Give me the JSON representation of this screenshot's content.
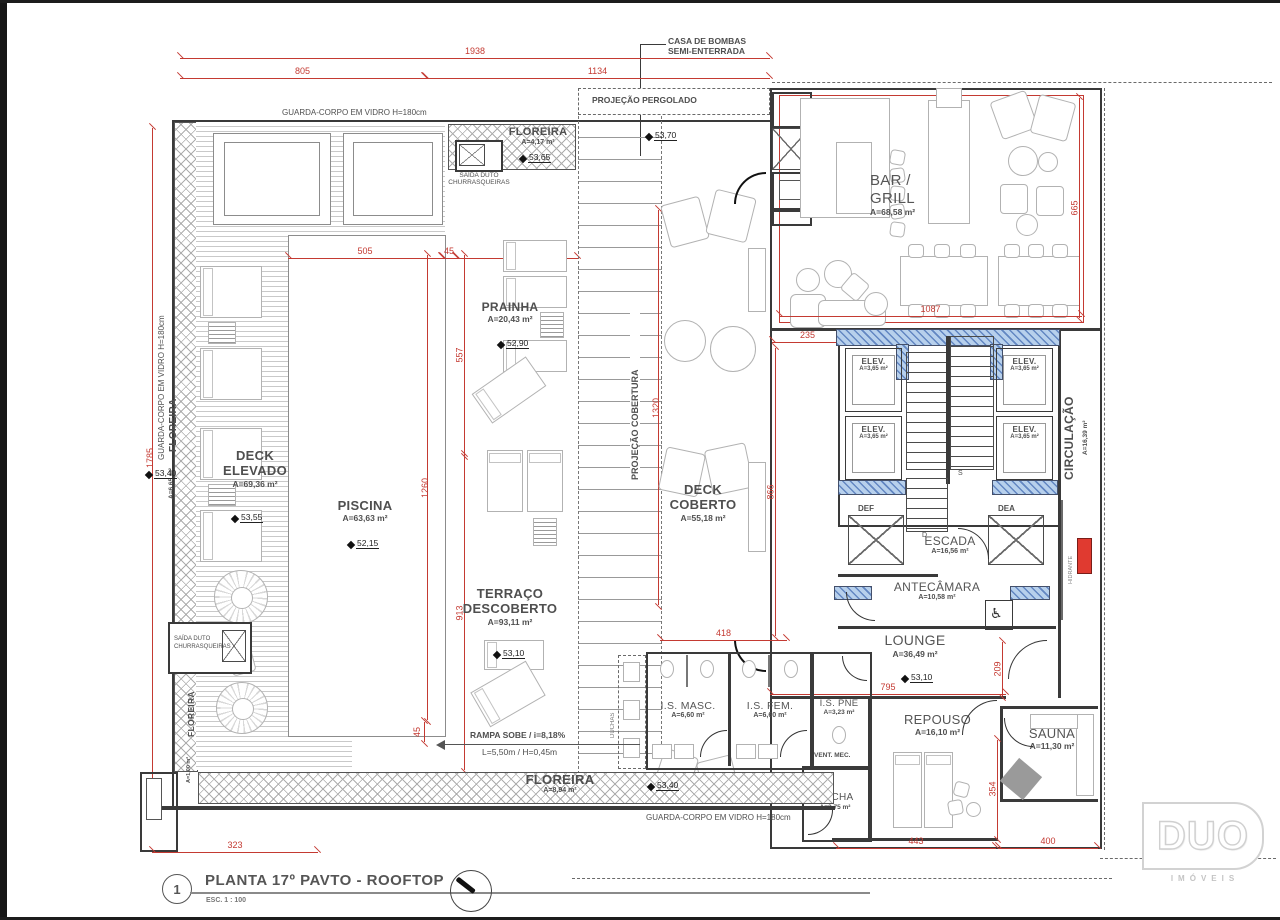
{
  "title_block": {
    "number": "1",
    "title": "PLANTA 17º PAVTO - ROOFTOP",
    "scale": "ESC. 1 : 100"
  },
  "logo": {
    "brand": "DUO",
    "subtitle": "IMÓVEIS"
  },
  "notes": {
    "casa_de_bombas_1": "CASA DE BOMBAS",
    "casa_de_bombas_2": "SEMI-ENTERRADA",
    "guarda_corpo": "GUARDA-CORPO EM VIDRO H=180cm",
    "projecao_pergolado": "PROJEÇÃO PERGOLADO",
    "projecao_cobertura": "PROJEÇÃO COBERTURA",
    "saida_duto_1": "SAÍDA DUTO",
    "saida_duto_2": "CHURRASQUEIRAS",
    "rampa_1": "RAMPA SOBE / i=8,18%",
    "rampa_2": "L=5,50m / H=0,45m",
    "vent_mec": "VENT. MEC.",
    "duchas": "DUCHAS",
    "def": "DEF",
    "dea": "DEA",
    "hidrante": "HIDRANTE",
    "stair_d": "D",
    "stair_s": "S"
  },
  "rooms": {
    "floreira_top": {
      "name": "FLOREIRA",
      "area": "A=4,17 m²",
      "level": "53,65"
    },
    "floreira_left": {
      "name": "FLOREIRA",
      "area": "A=6,65 m²",
      "level": "53,40"
    },
    "floreira_small": {
      "name": "FLOREIRA",
      "area": "A=1,00 m²"
    },
    "floreira_bottom": {
      "name": "FLOREIRA",
      "area": "A=8,94 m²",
      "level": "53,40"
    },
    "deck_elevado": {
      "name1": "DECK",
      "name2": "ELEVADO",
      "area": "A=69,36 m²",
      "level": "53,55"
    },
    "piscina": {
      "name": "PISCINA",
      "area": "A=63,63 m²",
      "level": "52,15"
    },
    "prainha": {
      "name": "PRAINHA",
      "area": "A=20,43 m²",
      "level": "52,90"
    },
    "terraco": {
      "name1": "TERRAÇO",
      "name2": "DESCOBERTO",
      "area": "A=93,11 m²",
      "level": "53,10"
    },
    "deck_coberto": {
      "name1": "DECK",
      "name2": "COBERTO",
      "area": "A=55,18 m²"
    },
    "bar_grill": {
      "name1": "BAR /",
      "name2": "GRILL",
      "area": "A=68,58 m²"
    },
    "elev": {
      "name": "ELEV.",
      "area": "A=3,65 m²"
    },
    "circulacao": {
      "name": "CIRCULAÇÃO",
      "area": "A=16,39 m²"
    },
    "escada": {
      "name": "ESCADA",
      "area": "A=16,56 m²"
    },
    "antecamara": {
      "name": "ANTECÂMARA",
      "area": "A=10,58 m²"
    },
    "lounge": {
      "name": "LOUNGE",
      "area": "A=36,49 m²",
      "level": "53,10"
    },
    "is_masc": {
      "name": "I.S. MASC.",
      "area": "A=6,60 m²"
    },
    "is_fem": {
      "name": "I.S. FEM.",
      "area": "A=6,60 m²"
    },
    "is_pne": {
      "name": "I.S. PNE",
      "area": "A=3,23 m²"
    },
    "ducha": {
      "name": "DUCHA",
      "area": "A=2,75 m²"
    },
    "repouso": {
      "name": "REPOUSO",
      "area": "A=16,10 m²"
    },
    "sauna": {
      "name": "SAUNA",
      "area": "A=11,30 m²"
    }
  },
  "levels": {
    "pergolado_top": "53,70"
  },
  "dims": {
    "v1938": "1938",
    "v805": "805",
    "v1134": "1134",
    "v1785": "1785",
    "v505": "505",
    "v45a": "45",
    "v405": "405",
    "v557": "557",
    "v913": "913",
    "v1260": "1260",
    "v45b": "45",
    "v1320": "1320",
    "v235": "235",
    "v866": "866",
    "v1087": "1087",
    "v665": "665",
    "v418": "418",
    "v795": "795",
    "v209": "209",
    "v354": "354",
    "v443": "443",
    "v400": "400",
    "v323": "323"
  },
  "colors": {
    "dim_red": "#c43a32",
    "wall_blue": "#b7d0ec",
    "hydrant_red": "#e03a30"
  }
}
